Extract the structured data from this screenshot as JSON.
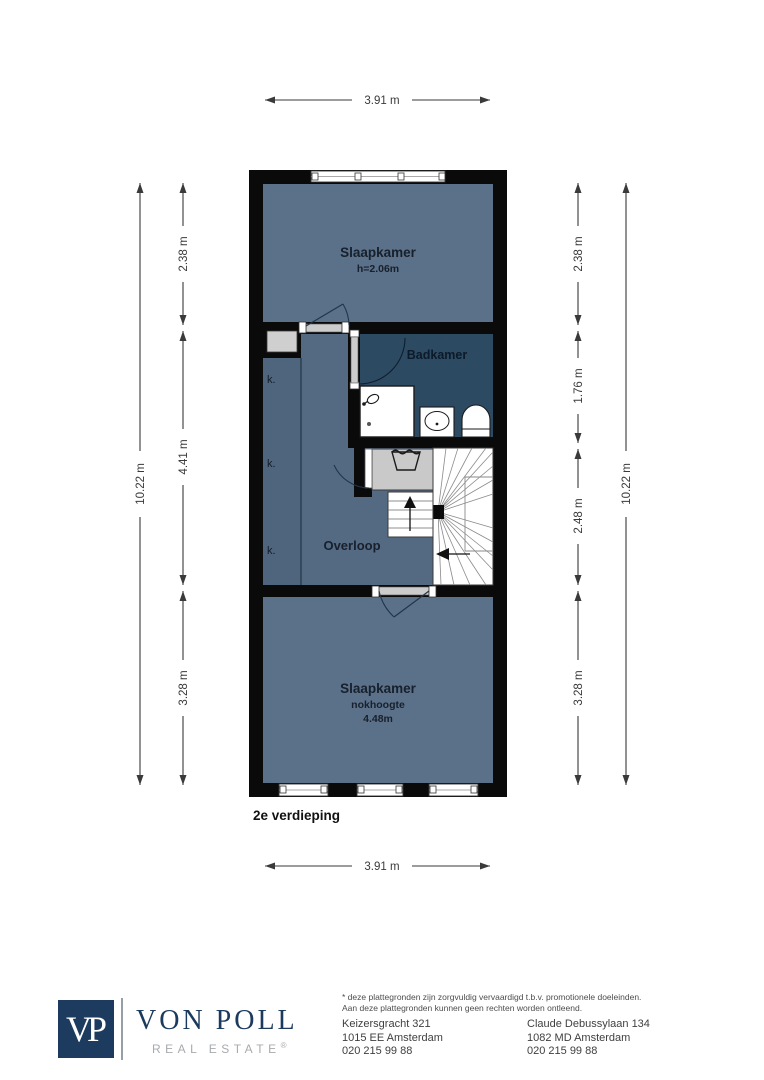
{
  "floorplan": {
    "floor_label": "2e verdieping",
    "closet_label": "k.",
    "rooms": {
      "bedroom_top": {
        "name": "Slaapkamer",
        "height_note": "h=2.06m"
      },
      "bathroom": {
        "name": "Badkamer"
      },
      "landing": {
        "name": "Overloop"
      },
      "bedroom_bottom": {
        "name": "Slaapkamer",
        "ridge_note_label": "nokhoogte",
        "ridge_note_value": "4.48m"
      }
    },
    "dimensions": {
      "width_top": "3.91 m",
      "width_bottom": "3.91 m",
      "height_left_total": "10.22 m",
      "height_right_total": "10.22 m",
      "left_segments": [
        "2.38 m",
        "4.41 m",
        "3.28 m"
      ],
      "right_segments": [
        "2.38 m",
        "1.76 m",
        "2.48 m",
        "3.28 m"
      ]
    },
    "icons": {
      "laundry": "laundry-tub-icon",
      "shower": "shower-head-icon",
      "sink": "sink-icon",
      "toilet": "toilet-icon",
      "stairs_up": "stairs-up-arrow-icon",
      "stairs_down": "stairs-down-arrow-icon"
    },
    "colors": {
      "wall": "#0a0a0a",
      "bedroom_fill": "#5b7189",
      "landing_fill": "#546a82",
      "closet_fill": "#4f657d",
      "bathroom_fill": "#2d4a63",
      "laundry_fill": "#c9c9c9"
    }
  },
  "footer": {
    "logo": {
      "monogram": "VP",
      "brand": "VON POLL",
      "tagline": "REAL ESTATE",
      "registered_mark": "®"
    },
    "disclaimer": {
      "line1": "* deze plattegronden zijn zorgvuldig vervaardigd t.b.v. promotionele doeleinden.",
      "line2": "Aan deze plattegronden kunnen geen rechten worden ontleend."
    },
    "offices": [
      {
        "address_line1": "Keizersgracht 321",
        "address_line2": "1015 EE Amsterdam",
        "phone": "020 215 99 88"
      },
      {
        "address_line1": "Claude Debussylaan 134",
        "address_line2": "1082 MD Amsterdam",
        "phone": "020 215 99 88"
      }
    ]
  }
}
